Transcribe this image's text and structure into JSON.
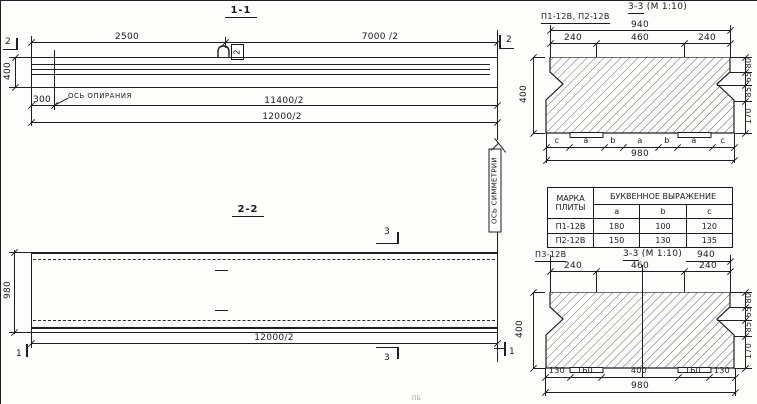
{
  "drawing": {
    "s11": {
      "title": "1-1",
      "d2500": "2500",
      "d7000": "7000 /2",
      "d400": "400",
      "d300": "300",
      "support_axis": "ОСЬ ОПИРАНИЯ",
      "d11400": "11400/2",
      "d12000": "12000/2",
      "marker2": "2",
      "hook_tag": "2"
    },
    "s22": {
      "title": "2-2",
      "d980": "980",
      "d12000": "12000/2",
      "marker3": "3",
      "marker1": "1",
      "symmetry_axis": "ОСЬ СИММЕТРИИ"
    },
    "c1": {
      "title": "3-3",
      "scale": "(М 1:10)",
      "subtitle": "П1-12В, П2-12В",
      "d940": "940",
      "t1": "240",
      "t2": "460",
      "t3": "240",
      "r1": "80",
      "r2": "65",
      "r3": "85",
      "r4": "170",
      "d400": "400",
      "l1": "c",
      "l2": "a",
      "l3": "b",
      "l4": "a",
      "l5": "b",
      "l6": "a",
      "l7": "c",
      "d980": "980"
    },
    "table": {
      "h_mark": "МАРКА ПЛИТЫ",
      "h_expr": "БУКВЕННОЕ ВЫРАЖЕНИЕ",
      "cols": [
        "a",
        "b",
        "c"
      ],
      "rows": [
        [
          "П1-12В",
          "180",
          "100",
          "120"
        ],
        [
          "П2-12В",
          "150",
          "130",
          "135"
        ]
      ]
    },
    "c2": {
      "label": "П3-12В",
      "title": "3-3",
      "scale": "(М 1:10)",
      "d940": "940",
      "t1": "240",
      "t2": "460",
      "t3": "240",
      "r1": "80",
      "r2": "65",
      "r3": "85",
      "r4": "170",
      "d400": "400",
      "b1": "130",
      "b2": "160",
      "b3": "400",
      "b4": "160",
      "b5": "130",
      "d980": "980"
    },
    "misc": {
      "partial_text": "ПБ"
    },
    "colors": {
      "ink": "#1f1f1f",
      "paper": "#fdfdfc"
    }
  }
}
